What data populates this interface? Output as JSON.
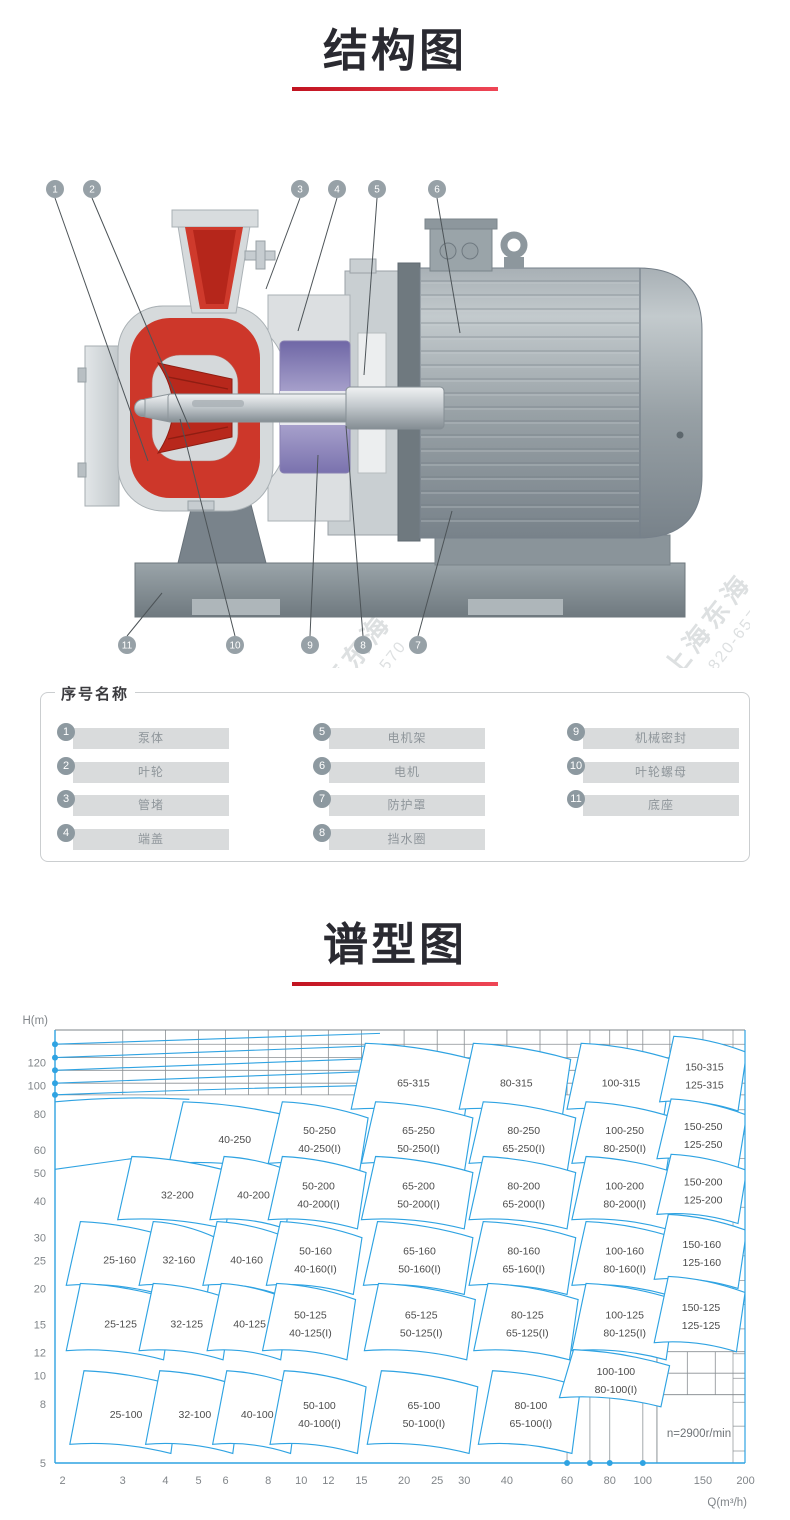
{
  "structure_section": {
    "title": "结构图"
  },
  "spectrum_section": {
    "title": "谱型图"
  },
  "diagram": {
    "watermark": {
      "brand": "上海东海",
      "phone": "800-820-6570"
    },
    "callouts": [
      {
        "num": "1",
        "cx": 15,
        "cy": 26,
        "tx": 108,
        "ty": 298
      },
      {
        "num": "2",
        "cx": 52,
        "cy": 26,
        "tx": 150,
        "ty": 266
      },
      {
        "num": "3",
        "cx": 260,
        "cy": 26,
        "tx": 226,
        "ty": 126
      },
      {
        "num": "4",
        "cx": 297,
        "cy": 26,
        "tx": 258,
        "ty": 168
      },
      {
        "num": "5",
        "cx": 337,
        "cy": 26,
        "tx": 324,
        "ty": 212
      },
      {
        "num": "6",
        "cx": 397,
        "cy": 26,
        "tx": 420,
        "ty": 170
      },
      {
        "num": "11",
        "cx": 87,
        "cy": 482,
        "tx": 122,
        "ty": 430
      },
      {
        "num": "10",
        "cx": 195,
        "cy": 482,
        "tx": 140,
        "ty": 256
      },
      {
        "num": "9",
        "cx": 270,
        "cy": 482,
        "tx": 278,
        "ty": 292
      },
      {
        "num": "8",
        "cx": 323,
        "cy": 482,
        "tx": 306,
        "ty": 263
      },
      {
        "num": "7",
        "cx": 378,
        "cy": 482,
        "tx": 412,
        "ty": 348
      }
    ]
  },
  "legend": {
    "title": "序号名称",
    "items": [
      {
        "num": "1",
        "label": "泵体"
      },
      {
        "num": "2",
        "label": "叶轮"
      },
      {
        "num": "3",
        "label": "管堵"
      },
      {
        "num": "4",
        "label": "端盖"
      },
      {
        "num": "5",
        "label": "电机架"
      },
      {
        "num": "6",
        "label": "电机"
      },
      {
        "num": "7",
        "label": "防护罩"
      },
      {
        "num": "8",
        "label": "挡水圈"
      },
      {
        "num": "9",
        "label": "机械密封"
      },
      {
        "num": "10",
        "label": "叶轮螺母"
      },
      {
        "num": "11",
        "label": "底座"
      }
    ]
  },
  "chart_data": {
    "type": "region-map",
    "title": "谱型图",
    "xlabel": "Q(m³/h)",
    "ylabel": "H(m)",
    "annotation": "n=2900r/min",
    "xlim": [
      1.9,
      200
    ],
    "ylim": [
      5,
      155
    ],
    "x_ticks": [
      2,
      3,
      4,
      5,
      6,
      8,
      10,
      12,
      15,
      20,
      25,
      30,
      40,
      60,
      80,
      100,
      150,
      200
    ],
    "y_ticks": [
      120,
      100,
      80,
      60,
      50,
      40,
      30,
      25,
      20,
      15,
      12,
      10,
      8,
      5
    ],
    "grid_band_h": [
      139,
      125,
      113,
      102,
      93
    ],
    "grid_band_q": [
      3,
      4,
      5,
      6,
      7,
      8,
      9,
      10,
      12,
      15,
      20,
      25,
      30,
      40,
      50,
      60,
      70,
      80,
      90,
      100,
      120,
      150
    ],
    "axis_dots_y": [
      139,
      125,
      113,
      102,
      93
    ],
    "axis_dots_x": [
      60,
      70,
      80,
      100
    ],
    "accent_blue": "#2fa3e2",
    "grid_gray": "#8a8f93",
    "arcs": [
      {
        "h": 139,
        "qe": 17,
        "k": 1.09
      },
      {
        "h": 125,
        "qe": 17,
        "k": 1.1
      },
      {
        "h": 113,
        "qe": 17,
        "k": 1.1
      },
      {
        "h": 102,
        "qe": 17,
        "k": 1.1
      },
      {
        "h": 93,
        "qe": 17,
        "k": 1.08
      },
      {
        "h": 88,
        "qe": 4.7,
        "k": 1.02
      },
      {
        "h": 51.5,
        "qe": 3.4,
        "k": 1.1
      }
    ],
    "regions": [
      {
        "labels": [
          "65-315"
        ],
        "q": [
          14,
          30
        ],
        "h": [
          83,
          140
        ]
      },
      {
        "labels": [
          "80-315"
        ],
        "q": [
          29,
          58
        ],
        "h": [
          83,
          140
        ]
      },
      {
        "labels": [
          "100-315"
        ],
        "q": [
          60,
          115
        ],
        "h": [
          83,
          140
        ]
      },
      {
        "labels": [
          "150-315",
          "125-315"
        ],
        "q": [
          112,
          190
        ],
        "h": [
          88,
          148
        ]
      },
      {
        "labels": [
          "40-250"
        ],
        "q": [
          4.1,
          9.2
        ],
        "h": [
          54,
          88
        ]
      },
      {
        "labels": [
          "50-250",
          "40-250(I)"
        ],
        "q": [
          8.0,
          14.8
        ],
        "h": [
          54,
          88
        ]
      },
      {
        "labels": [
          "65-250",
          "50-250(I)"
        ],
        "q": [
          15,
          30
        ],
        "h": [
          54,
          88
        ]
      },
      {
        "labels": [
          "80-250",
          "65-250(I)"
        ],
        "q": [
          31,
          60
        ],
        "h": [
          54,
          88
        ]
      },
      {
        "labels": [
          "100-250",
          "80-250(I)"
        ],
        "q": [
          62,
          117
        ],
        "h": [
          54,
          88
        ]
      },
      {
        "labels": [
          "150-250",
          "125-250"
        ],
        "q": [
          110,
          190
        ],
        "h": [
          56,
          90
        ]
      },
      {
        "labels": [
          "32-200"
        ],
        "q": [
          2.9,
          6.0
        ],
        "h": [
          34.5,
          57
        ]
      },
      {
        "labels": [
          "40-200"
        ],
        "q": [
          5.4,
          9.0
        ],
        "h": [
          34.5,
          57
        ]
      },
      {
        "labels": [
          "50-200",
          "40-200(I)"
        ],
        "q": [
          8.0,
          14.6
        ],
        "h": [
          34.5,
          57
        ]
      },
      {
        "labels": [
          "65-200",
          "50-200(I)"
        ],
        "q": [
          15,
          30
        ],
        "h": [
          34.5,
          57
        ]
      },
      {
        "labels": [
          "80-200",
          "65-200(I)"
        ],
        "q": [
          31,
          60
        ],
        "h": [
          34.5,
          57
        ]
      },
      {
        "labels": [
          "100-200",
          "80-200(I)"
        ],
        "q": [
          62,
          117
        ],
        "h": [
          34.5,
          57
        ]
      },
      {
        "labels": [
          "150-200",
          "125-200"
        ],
        "q": [
          110,
          190
        ],
        "h": [
          36,
          58
        ]
      },
      {
        "labels": [
          "25-160"
        ],
        "q": [
          2.05,
          3.9
        ],
        "h": [
          20.5,
          34
        ]
      },
      {
        "labels": [
          "32-160"
        ],
        "q": [
          3.35,
          5.3
        ],
        "h": [
          20.5,
          34
        ]
      },
      {
        "labels": [
          "40-160"
        ],
        "q": [
          5.15,
          8.6
        ],
        "h": [
          20.5,
          34
        ]
      },
      {
        "labels": [
          "50-160",
          "40-160(I)"
        ],
        "q": [
          7.9,
          14.2
        ],
        "h": [
          20.5,
          34
        ]
      },
      {
        "labels": [
          "65-160",
          "50-160(I)"
        ],
        "q": [
          15.2,
          30
        ],
        "h": [
          20.5,
          34
        ]
      },
      {
        "labels": [
          "80-160",
          "65-160(I)"
        ],
        "q": [
          31,
          60
        ],
        "h": [
          20.5,
          34
        ]
      },
      {
        "labels": [
          "100-160",
          "80-160(I)"
        ],
        "q": [
          62,
          117
        ],
        "h": [
          20.5,
          34
        ]
      },
      {
        "labels": [
          "150-160",
          "125-160"
        ],
        "q": [
          108,
          190
        ],
        "h": [
          21.5,
          36
        ]
      },
      {
        "labels": [
          "25-125"
        ],
        "q": [
          2.05,
          3.95
        ],
        "h": [
          12.2,
          20.8
        ]
      },
      {
        "labels": [
          "32-125"
        ],
        "q": [
          3.35,
          5.9
        ],
        "h": [
          12.2,
          20.8
        ]
      },
      {
        "labels": [
          "40-125"
        ],
        "q": [
          5.3,
          8.7
        ],
        "h": [
          12.2,
          20.8
        ]
      },
      {
        "labels": [
          "50-125",
          "40-125(I)"
        ],
        "q": [
          7.7,
          13.6
        ],
        "h": [
          12.2,
          20.8
        ]
      },
      {
        "labels": [
          "65-125",
          "50-125(I)"
        ],
        "q": [
          15.3,
          30.5
        ],
        "h": [
          12.2,
          20.8
        ]
      },
      {
        "labels": [
          "80-125",
          "65-125(I)"
        ],
        "q": [
          32,
          61
        ],
        "h": [
          12.2,
          20.8
        ]
      },
      {
        "labels": [
          "100-125",
          "80-125(I)"
        ],
        "q": [
          62,
          117
        ],
        "h": [
          12.2,
          20.8
        ]
      },
      {
        "labels": [
          "150-125",
          "125-125"
        ],
        "q": [
          108,
          188
        ],
        "h": [
          13,
          22
        ]
      },
      {
        "labels": [
          "25-100"
        ],
        "q": [
          2.1,
          4.15
        ],
        "h": [
          5.8,
          10.4
        ]
      },
      {
        "labels": [
          "32-100"
        ],
        "q": [
          3.5,
          6.3
        ],
        "h": [
          5.8,
          10.4
        ]
      },
      {
        "labels": [
          "40-100"
        ],
        "q": [
          5.5,
          9.3
        ],
        "h": [
          5.8,
          10.4
        ]
      },
      {
        "labels": [
          "50-100",
          "40-100(I)"
        ],
        "q": [
          8.1,
          14.6
        ],
        "h": [
          5.8,
          10.4
        ]
      },
      {
        "labels": [
          "65-100",
          "50-100(I)"
        ],
        "q": [
          15.6,
          31
        ],
        "h": [
          5.8,
          10.4
        ]
      },
      {
        "labels": [
          "80-100",
          "65-100(I)"
        ],
        "q": [
          33,
          62
        ],
        "h": [
          5.8,
          10.4
        ]
      },
      {
        "labels": [
          "100-100",
          "80-100(I)"
        ],
        "q": [
          57,
          113
        ],
        "h": [
          8.4,
          12.3
        ]
      }
    ]
  }
}
